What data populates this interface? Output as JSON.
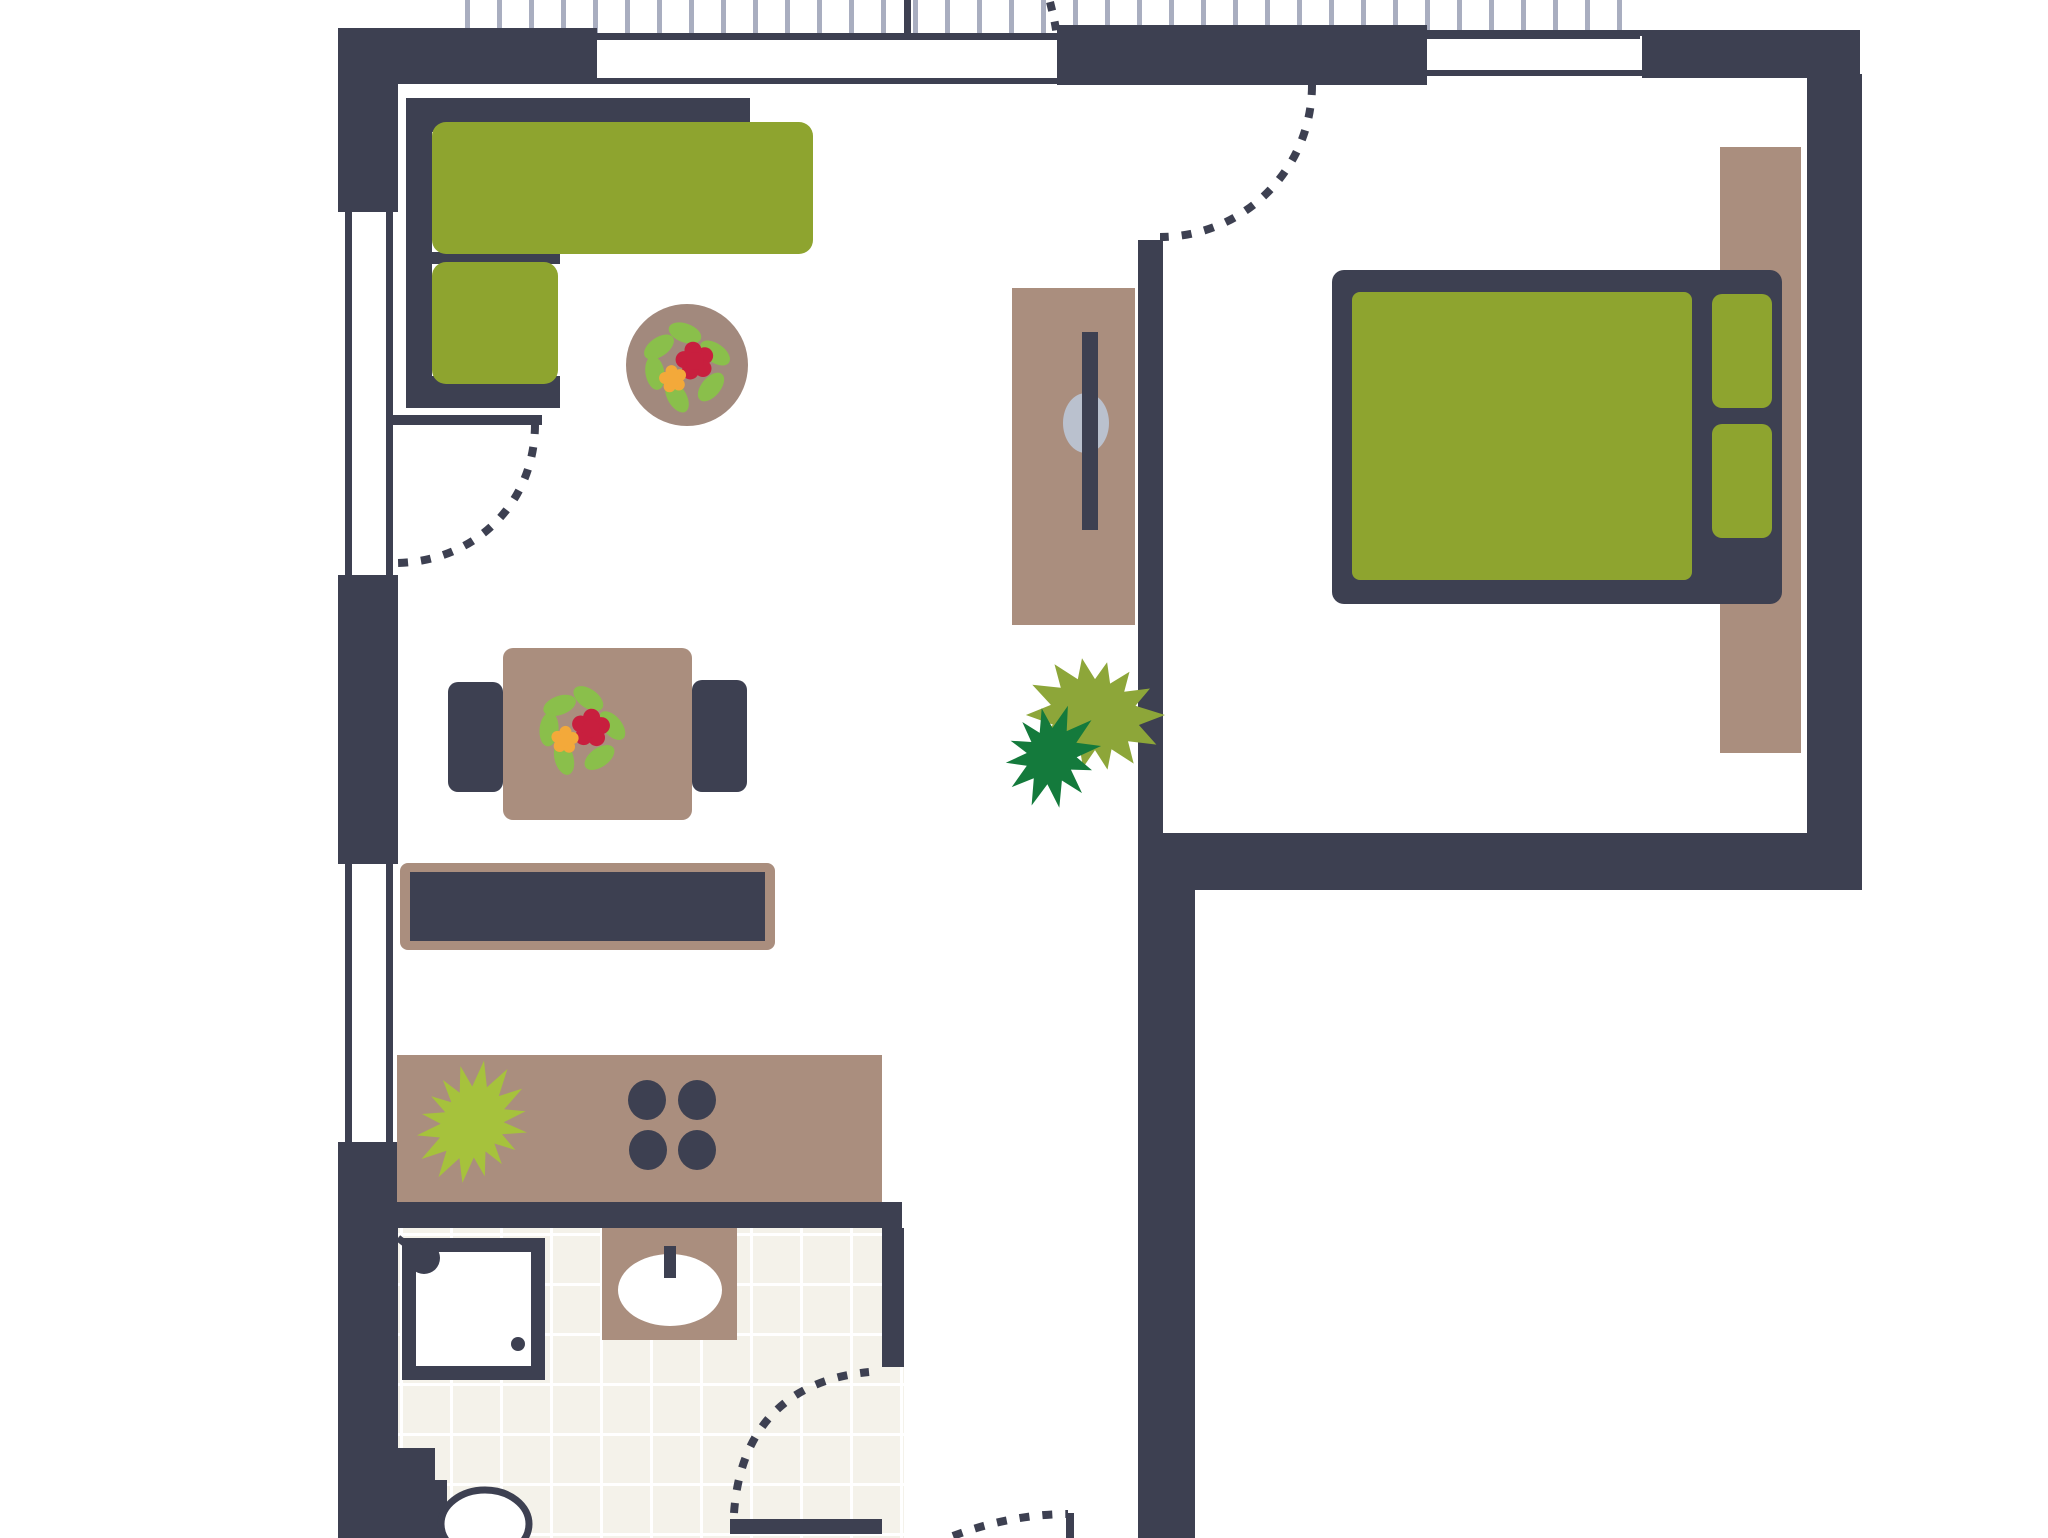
{
  "canvas": {
    "w": 2048,
    "h": 1538,
    "bg": "#ffffff"
  },
  "palette": {
    "wall": "#3d4051",
    "green": "#8ea42f",
    "green_bright": "#a6c23c",
    "green_olive": "#8da639",
    "green_dark": "#147a3c",
    "leaf": "#8abf4b",
    "red": "#c81f3e",
    "orange": "#f3a93a",
    "taupe": "#aa8e7e",
    "taupe_dark": "#a2897d",
    "gray": "#bac1ce",
    "tick": "#a9aec0",
    "tile": "#f4f2ea",
    "grout": "#ffffff",
    "white": "#ffffff"
  },
  "layers": [
    {
      "name": "floors",
      "items": [
        {
          "n": "bathroom-tile-floor",
          "t": "tilefloor",
          "x": 398,
          "y": 1228,
          "w": 484,
          "h": 310,
          "cell": 50,
          "ox": 2,
          "oy": 5,
          "lw": 3,
          "f": "tile",
          "lf": "grout"
        },
        {
          "n": "bathroom-door-tile-strip",
          "t": "tilefloor",
          "x": 882,
          "y": 1367,
          "w": 22,
          "h": 171,
          "cell": 50,
          "ox": 18,
          "oy": 16,
          "lw": 3,
          "f": "tile",
          "lf": "grout"
        }
      ]
    },
    {
      "name": "balcony-railing",
      "items": [
        {
          "n": "railing-ticks",
          "t": "ticks",
          "x1": 465,
          "x2": 1640,
          "y": 0,
          "h": 34,
          "step": 32,
          "w": 5,
          "f": "tick"
        },
        {
          "n": "railing-base-line",
          "t": "rect",
          "x": 465,
          "y": 33,
          "w": 1175,
          "h": 6,
          "f": "wall"
        },
        {
          "n": "railing-divider",
          "t": "rect",
          "x": 904,
          "y": 0,
          "w": 7,
          "h": 38,
          "f": "wall"
        }
      ]
    },
    {
      "name": "windows",
      "items": [
        {
          "n": "window-top-living-outer",
          "t": "rect",
          "x": 597,
          "y": 34,
          "w": 471,
          "h": 6,
          "f": "wall"
        },
        {
          "n": "window-top-living-inner",
          "t": "rect",
          "x": 597,
          "y": 78,
          "w": 471,
          "h": 6,
          "f": "wall"
        },
        {
          "n": "window-top-bedroom-outer",
          "t": "rect",
          "x": 1427,
          "y": 30,
          "w": 215,
          "h": 6,
          "f": "wall"
        },
        {
          "n": "window-top-bedroom-inner",
          "t": "rect",
          "x": 1427,
          "y": 70,
          "w": 215,
          "h": 6,
          "f": "wall"
        },
        {
          "n": "window-left-living-outer",
          "t": "rect",
          "x": 345,
          "y": 210,
          "w": 7,
          "h": 365,
          "f": "wall"
        },
        {
          "n": "window-left-living-inner",
          "t": "rect",
          "x": 386,
          "y": 210,
          "w": 7,
          "h": 365,
          "f": "wall"
        },
        {
          "n": "window-left-kitchen-outer",
          "t": "rect",
          "x": 345,
          "y": 864,
          "w": 7,
          "h": 278,
          "f": "wall"
        },
        {
          "n": "window-left-kitchen-inner",
          "t": "rect",
          "x": 386,
          "y": 864,
          "w": 7,
          "h": 278,
          "f": "wall"
        }
      ]
    },
    {
      "name": "walls",
      "items": [
        {
          "n": "wall-top-left",
          "t": "rect",
          "x": 345,
          "y": 28,
          "w": 252,
          "h": 56,
          "f": "wall"
        },
        {
          "n": "wall-left-upper",
          "t": "rect",
          "x": 338,
          "y": 28,
          "w": 60,
          "h": 184,
          "f": "wall"
        },
        {
          "n": "wall-left-middle",
          "t": "rect",
          "x": 338,
          "y": 575,
          "w": 60,
          "h": 289,
          "f": "wall"
        },
        {
          "n": "wall-left-lower",
          "t": "rect",
          "x": 338,
          "y": 1142,
          "w": 60,
          "h": 396,
          "f": "wall"
        },
        {
          "n": "wall-top-middle",
          "t": "rect",
          "x": 1057,
          "y": 25,
          "w": 370,
          "h": 60,
          "f": "wall"
        },
        {
          "n": "wall-top-right",
          "t": "rect",
          "x": 1642,
          "y": 30,
          "w": 218,
          "h": 48,
          "f": "wall"
        },
        {
          "n": "wall-right",
          "t": "rect",
          "x": 1807,
          "y": 74,
          "w": 55,
          "h": 816,
          "f": "wall"
        },
        {
          "n": "wall-bedroom-bottom",
          "t": "rect",
          "x": 1138,
          "y": 833,
          "w": 724,
          "h": 57,
          "f": "wall"
        },
        {
          "n": "wall-divider-bedroom",
          "t": "rect",
          "x": 1138,
          "y": 240,
          "w": 25,
          "h": 593,
          "f": "wall"
        },
        {
          "n": "wall-corridor-right",
          "t": "rect",
          "x": 1138,
          "y": 890,
          "w": 57,
          "h": 648,
          "f": "wall"
        },
        {
          "n": "wall-bathroom-top",
          "t": "rect",
          "x": 347,
          "y": 1202,
          "w": 555,
          "h": 26,
          "f": "wall"
        },
        {
          "n": "wall-bathroom-right",
          "t": "rect",
          "x": 882,
          "y": 1228,
          "w": 22,
          "h": 139,
          "f": "wall"
        }
      ]
    },
    {
      "name": "living-room",
      "items": [
        {
          "n": "sofa-back-top",
          "t": "rect",
          "x": 406,
          "y": 98,
          "w": 344,
          "h": 34,
          "f": "wall"
        },
        {
          "n": "sofa-back-left",
          "t": "rect",
          "x": 406,
          "y": 98,
          "w": 26,
          "h": 310,
          "f": "wall"
        },
        {
          "n": "sofa-back-bottom",
          "t": "rect",
          "x": 406,
          "y": 376,
          "w": 154,
          "h": 32,
          "f": "wall"
        },
        {
          "n": "sofa-back-middle",
          "t": "rect",
          "x": 432,
          "y": 252,
          "w": 128,
          "h": 12,
          "f": "wall"
        },
        {
          "n": "sofa-seat-long",
          "t": "rect",
          "x": 432,
          "y": 122,
          "w": 381,
          "h": 132,
          "rx": 14,
          "f": "green"
        },
        {
          "n": "sofa-seat-short",
          "t": "rect",
          "x": 432,
          "y": 262,
          "w": 126,
          "h": 122,
          "rx": 14,
          "f": "green"
        },
        {
          "n": "coffee-table",
          "t": "ellipse",
          "cx": 687,
          "cy": 365,
          "rx": 61,
          "ry": 61,
          "f": "taupe_dark"
        },
        {
          "n": "coffee-table-flower",
          "t": "flower",
          "cx": 687,
          "cy": 365,
          "rot": 0
        },
        {
          "n": "dining-chair-left",
          "t": "rect",
          "x": 448,
          "y": 682,
          "w": 55,
          "h": 110,
          "rx": 10,
          "f": "wall"
        },
        {
          "n": "dining-chair-right",
          "t": "rect",
          "x": 692,
          "y": 680,
          "w": 55,
          "h": 112,
          "rx": 10,
          "f": "wall"
        },
        {
          "n": "dining-table",
          "t": "rect",
          "x": 503,
          "y": 648,
          "w": 189,
          "h": 172,
          "rx": 10,
          "f": "taupe"
        },
        {
          "n": "dining-table-flower",
          "t": "flower",
          "cx": 582,
          "cy": 730,
          "rot": 15
        },
        {
          "n": "sideboard-body",
          "t": "rect",
          "x": 400,
          "y": 863,
          "w": 375,
          "h": 87,
          "rx": 8,
          "f": "taupe"
        },
        {
          "n": "sideboard-top",
          "t": "rect",
          "x": 410,
          "y": 872,
          "w": 355,
          "h": 69,
          "f": "wall"
        }
      ]
    },
    {
      "name": "kitchen",
      "items": [
        {
          "n": "kitchen-counter",
          "t": "rect",
          "x": 397,
          "y": 1055,
          "w": 485,
          "h": 147,
          "f": "taupe"
        },
        {
          "n": "kitchen-plant",
          "t": "star",
          "cx": 473,
          "cy": 1123,
          "np": 16,
          "ro": 57,
          "ri": 34,
          "rot": 10,
          "f": "green_bright"
        },
        {
          "n": "stove-burner-1",
          "t": "ellipse",
          "cx": 647,
          "cy": 1100,
          "rx": 19,
          "ry": 20,
          "f": "wall"
        },
        {
          "n": "stove-burner-2",
          "t": "ellipse",
          "cx": 697,
          "cy": 1100,
          "rx": 19,
          "ry": 20,
          "f": "wall"
        },
        {
          "n": "stove-burner-3",
          "t": "ellipse",
          "cx": 648,
          "cy": 1150,
          "rx": 19,
          "ry": 20,
          "f": "wall"
        },
        {
          "n": "stove-burner-4",
          "t": "ellipse",
          "cx": 697,
          "cy": 1150,
          "rx": 19,
          "ry": 20,
          "f": "wall"
        }
      ]
    },
    {
      "name": "bathroom",
      "items": [
        {
          "n": "shower-frame",
          "t": "rect",
          "x": 402,
          "y": 1238,
          "w": 143,
          "h": 142,
          "f": "wall"
        },
        {
          "n": "shower-basin",
          "t": "rect",
          "x": 416,
          "y": 1252,
          "w": 115,
          "h": 114,
          "f": "white"
        },
        {
          "n": "shower-hose",
          "t": "line",
          "x1": 398,
          "y1": 1238,
          "x2": 426,
          "y2": 1260,
          "s": "wall",
          "w": 7
        },
        {
          "n": "shower-head",
          "t": "ellipse",
          "cx": 424,
          "cy": 1258,
          "rx": 16,
          "ry": 16,
          "f": "wall"
        },
        {
          "n": "shower-drain",
          "t": "ellipse",
          "cx": 518,
          "cy": 1344,
          "rx": 7,
          "ry": 7,
          "f": "wall"
        },
        {
          "n": "sink-pedestal",
          "t": "rect",
          "x": 602,
          "y": 1228,
          "w": 135,
          "h": 112,
          "f": "taupe"
        },
        {
          "n": "sink-basin",
          "t": "ellipse",
          "cx": 670,
          "cy": 1290,
          "rx": 52,
          "ry": 36,
          "f": "white"
        },
        {
          "n": "sink-tap",
          "t": "rect",
          "x": 664,
          "y": 1246,
          "w": 12,
          "h": 32,
          "f": "wall"
        },
        {
          "n": "toilet-tank-upper",
          "t": "rect",
          "x": 390,
          "y": 1448,
          "w": 45,
          "h": 34,
          "f": "wall"
        },
        {
          "n": "toilet-tank-lower",
          "t": "rect",
          "x": 390,
          "y": 1480,
          "w": 57,
          "h": 58,
          "f": "wall"
        },
        {
          "n": "toilet-bowl",
          "t": "ellipse",
          "cx": 485,
          "cy": 1524,
          "rx": 44,
          "ry": 34,
          "f": "white",
          "s": "wall",
          "sw": 7
        }
      ]
    },
    {
      "name": "hall-and-desk",
      "items": [
        {
          "n": "desk",
          "t": "rect",
          "x": 1012,
          "y": 288,
          "w": 123,
          "h": 337,
          "f": "taupe"
        },
        {
          "n": "desk-chair",
          "t": "ellipse",
          "cx": 1086,
          "cy": 423,
          "rx": 23,
          "ry": 30,
          "f": "gray"
        },
        {
          "n": "desk-monitor",
          "t": "rect",
          "x": 1082,
          "y": 332,
          "w": 16,
          "h": 198,
          "f": "wall"
        },
        {
          "n": "plant-olive",
          "t": "star",
          "cx": 1095,
          "cy": 715,
          "np": 14,
          "ro": 62,
          "ri": 40,
          "rot": 0,
          "f": "green_olive"
        },
        {
          "n": "plant-dark",
          "t": "star",
          "cx": 1050,
          "cy": 755,
          "np": 12,
          "ro": 48,
          "ri": 26,
          "rot": 20,
          "f": "green_dark"
        }
      ]
    },
    {
      "name": "bedroom",
      "items": [
        {
          "n": "wardrobe-strip",
          "t": "rect",
          "x": 1720,
          "y": 147,
          "w": 81,
          "h": 606,
          "f": "taupe"
        },
        {
          "n": "bed-frame",
          "t": "rect",
          "x": 1332,
          "y": 270,
          "w": 450,
          "h": 334,
          "rx": 12,
          "f": "wall"
        },
        {
          "n": "bed-mattress",
          "t": "rect",
          "x": 1352,
          "y": 292,
          "w": 340,
          "h": 288,
          "rx": 8,
          "f": "green"
        },
        {
          "n": "bed-pillow-top",
          "t": "rect",
          "x": 1712,
          "y": 294,
          "w": 60,
          "h": 114,
          "rx": 10,
          "f": "green"
        },
        {
          "n": "bed-pillow-bottom",
          "t": "rect",
          "x": 1712,
          "y": 424,
          "w": 60,
          "h": 114,
          "rx": 10,
          "f": "green"
        }
      ]
    },
    {
      "name": "doors",
      "items": [
        {
          "n": "living-door-leaf",
          "t": "rect",
          "x": 388,
          "y": 415,
          "w": 154,
          "h": 10,
          "f": "wall"
        },
        {
          "n": "living-door-swing-arc",
          "t": "path",
          "d": "M 535,424 C 535,504 474,563 394,563",
          "s": "wall",
          "w": 8,
          "dash": "10 13"
        },
        {
          "n": "bedroom-door-swing-arc",
          "t": "path",
          "d": "M 1312,85 C 1312,169 1244,237 1160,237",
          "s": "wall",
          "w": 8,
          "dash": "10 13"
        },
        {
          "n": "balcony-door-swing-arc",
          "t": "path",
          "d": "M 1050,2 C 1053,14 1056,26 1057,38",
          "s": "wall",
          "w": 8,
          "dash": "9 11"
        },
        {
          "n": "bathroom-door-leaf",
          "t": "rect",
          "x": 730,
          "y": 1519,
          "w": 152,
          "h": 15,
          "f": "wall"
        },
        {
          "n": "bathroom-door-swing-arc",
          "t": "path",
          "d": "M 734,1513 C 740,1429 786,1380 869,1372",
          "s": "wall",
          "w": 8,
          "dash": "10 13"
        },
        {
          "n": "entry-door-leaf",
          "t": "rect",
          "x": 1066,
          "y": 1513,
          "w": 8,
          "h": 25,
          "f": "wall"
        },
        {
          "n": "entry-door-swing-arc",
          "t": "path",
          "d": "M 953,1536 C 990,1522 1030,1514 1068,1514",
          "s": "wall",
          "w": 8,
          "dash": "10 13"
        }
      ]
    }
  ]
}
